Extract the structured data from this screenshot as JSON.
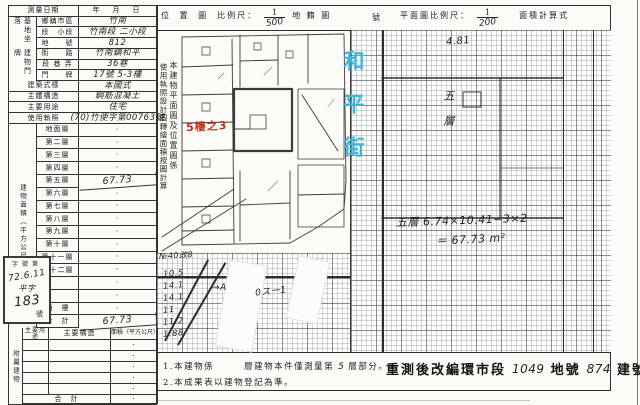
{
  "header": {
    "location_title": "位 置 圖",
    "scale_label": "比例尺：",
    "location_scale_num": "1",
    "location_scale_den": "500",
    "cadastral_label": "地 籍 圖",
    "sheet_no_label": "號",
    "plan_scale_label": "平面圖比例尺：",
    "plan_scale_num": "1",
    "plan_scale_den": "200",
    "area_calc_label": "面積計算式"
  },
  "survey_form": {
    "groups": {
      "site": "基地坐落",
      "address": "建物門牌",
      "area": "建物面積（平方公尺）",
      "annex": "附屬建物"
    },
    "top_rows": [
      {
        "label": "測量日期",
        "value": "年　月　日",
        "hw": false
      },
      {
        "label": "鄉鎮市區",
        "value": "竹南",
        "hw": true
      },
      {
        "label": "段　小段",
        "value": "竹南段 二小段",
        "hw": true
      },
      {
        "label": "地　　號",
        "value": "812",
        "hw": true
      },
      {
        "label": "街　　路",
        "value": "竹南鎮和平",
        "hw": true
      },
      {
        "label": "段 巷 弄",
        "value": "36巷",
        "hw": true
      },
      {
        "label": "門　　牌",
        "value": "17號 5-3樓",
        "hw": true
      },
      {
        "label": "建築式樣",
        "value": "本國式",
        "hw": true
      },
      {
        "label": "主體構造",
        "value": "鋼筋混凝土",
        "hw": true
      },
      {
        "label": "主要用途",
        "value": "住宅",
        "hw": true
      },
      {
        "label": "使用執照",
        "value": "(70)竹使字第00763號",
        "hw": true
      }
    ],
    "floors": [
      {
        "label": "地面層",
        "value": "·",
        "hw": false
      },
      {
        "label": "第二層",
        "value": "·",
        "hw": false
      },
      {
        "label": "第三層",
        "value": "·",
        "hw": false
      },
      {
        "label": "第四層",
        "value": "·",
        "hw": false
      },
      {
        "label": "第五層",
        "value": "67.73",
        "hw": true
      },
      {
        "label": "第六層",
        "value": "·",
        "hw": false
      },
      {
        "label": "第七層",
        "value": "·",
        "hw": false
      },
      {
        "label": "第八層",
        "value": "·",
        "hw": false
      },
      {
        "label": "第九層",
        "value": "·",
        "hw": false
      },
      {
        "label": "第十層",
        "value": "·",
        "hw": false
      },
      {
        "label": "第十一層",
        "value": "·",
        "hw": false
      },
      {
        "label": "第十二層",
        "value": "·",
        "hw": false
      },
      {
        "label": "",
        "value": "·",
        "hw": false
      },
      {
        "label": "",
        "value": "·",
        "hw": false
      },
      {
        "label": "騎　樓",
        "value": "·",
        "hw": false
      },
      {
        "label": "合　計",
        "value": "67.73",
        "hw": true
      }
    ],
    "annex": {
      "headers": [
        "主要用途",
        "主要構造",
        "面積（平方公尺）"
      ],
      "rows": [
        "·",
        "·",
        "·",
        "·",
        "·"
      ],
      "total_label": "合　計",
      "total_value": "·"
    }
  },
  "stamp": {
    "header": "字號第",
    "date": "72.6.11",
    "prefix": "平字",
    "number": "183",
    "suffix": "號"
  },
  "location_map": {
    "note_col1": "本建物平面圖及位置圖係",
    "note_col2": "使用執照設計圖轉繪面積按圖計算",
    "red_label": "5樓之3",
    "street": "和平街"
  },
  "floor_plan": {
    "dim_top": "4.81",
    "room_vertical": "五層",
    "calc_line1": "五層 6.74×10.41−3×2",
    "calc_line2": "＝ 67.73 m²"
  },
  "notes": {
    "line1_a": "1.本建物係",
    "line1_b": "層建物本件僅測量第",
    "line1_hw": "5",
    "line1_c": "層部分。",
    "line2": "2.本成果表以建物登記為準。"
  },
  "remeasure": {
    "label_a": "重測後改編環市段",
    "lot_no": "1049",
    "label_b": "地號",
    "bldg_no": "874",
    "label_c": "建號"
  },
  "scrawls": {
    "top": "№40改8",
    "numbers": [
      "10.5",
      "14.1",
      "14.1",
      "11",
      "11.2",
      "1.88"
    ],
    "mark_a": "→A",
    "mark_b": "0スー1"
  }
}
